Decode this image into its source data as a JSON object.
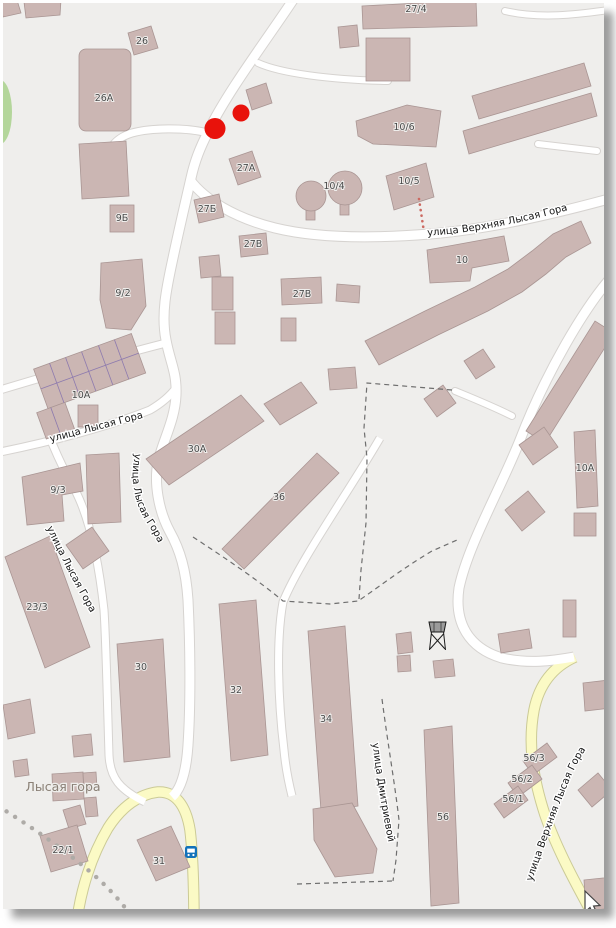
{
  "map": {
    "streets": {
      "verkhnyaya_top": "улица Верхняя Лысая Гора",
      "lysaya_horizontal": "улица Лысая Гора",
      "lysaya_main": "улица Лысая Гора",
      "lysaya_west": "улица Лысая Гора",
      "dmitrievoy": "улица Дмитриевой",
      "verkhnyaya_bottom": "улица Верхняя Лысая Гора"
    },
    "places": {
      "village": "Лысая гора"
    },
    "buildings": {
      "b26": "26",
      "b26a": "26А",
      "b27_4": "27/4",
      "b9b": "9Б",
      "b27a": "27А",
      "b27b": "27Б",
      "b27v_1": "27В",
      "b9_2": "9/2",
      "b27v_2": "27В",
      "b10_6": "10/6",
      "b10_5": "10/5",
      "b10_4": "10/4",
      "b10": "10",
      "b10a_garages": "10А",
      "b30a": "30А",
      "b36": "36",
      "b9_3": "9/3",
      "b10a_east": "10А",
      "b23_3": "23/3",
      "b30": "30",
      "b32": "32",
      "b34": "34",
      "b56": "56",
      "b56_3": "56/3",
      "b56_2": "56/2",
      "b56_1": "56/1",
      "b22_1": "22/1",
      "b31": "31"
    },
    "icons": {
      "red_markers": "red-dot-markers",
      "bus_stop": "bus-stop-icon",
      "water_tower": "water-tower-icon",
      "cursor": "mouse-cursor-icon"
    },
    "colors": {
      "land": "#efeeec",
      "building_fill": "#cbb6b3",
      "building_stroke": "#a99593",
      "road_fill": "#ffffff",
      "road_casing": "#d6d3d0",
      "yellow_road_fill": "#fbfac5",
      "yellow_road_casing": "#cbca96",
      "marker_red": "#e8120b",
      "green_area": "#b4d69b",
      "garage_divider": "#8d7aae"
    }
  }
}
